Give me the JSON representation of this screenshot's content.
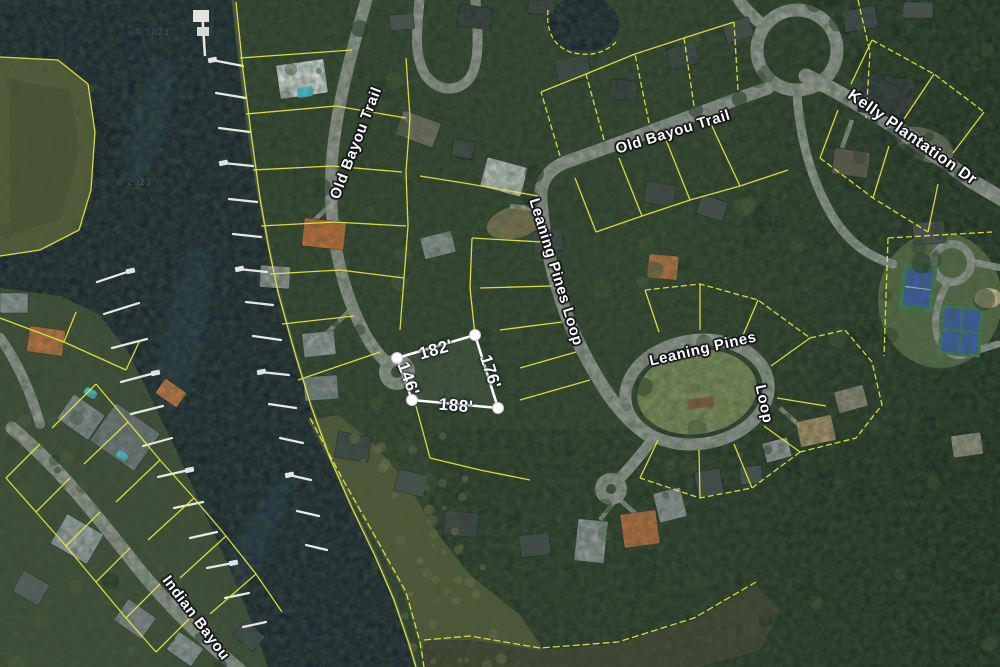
{
  "map": {
    "type": "satellite-parcel-view",
    "streets": {
      "old_bayou_left": "Old Bayou Trail",
      "old_bayou_main": "Old Bayou Trail",
      "kelly_plantation": "Kelly Plantation Dr",
      "leaning_pines_vertical": "Leaning Pines Loop",
      "leaning_pines_right": "Leaning Pines",
      "leaning_pines_right_loop": "Loop",
      "indian_bayou": "Indian Bayou"
    },
    "parcel": {
      "dim_top": "182'",
      "dim_right": "176'",
      "dim_bottom": "188'",
      "dim_left": "146'"
    },
    "watermark": "© 2023",
    "colors": {
      "water": "#1d2731",
      "water_streak": "#2c3a4d",
      "forest": "#2f3f2c",
      "forest_dark": "#22311f",
      "marsh": "#555c38",
      "marsh_dark": "#3f4030",
      "land_left": "#3d4a36",
      "road": "#90948e",
      "parcel_line": "#e6e83b",
      "lot_outline": "#ffffff",
      "dock": "#e8e8e2",
      "court_blue": "#3a5ba8",
      "court_green": "#3e7a4e",
      "pool": "#4ec3d8"
    }
  }
}
